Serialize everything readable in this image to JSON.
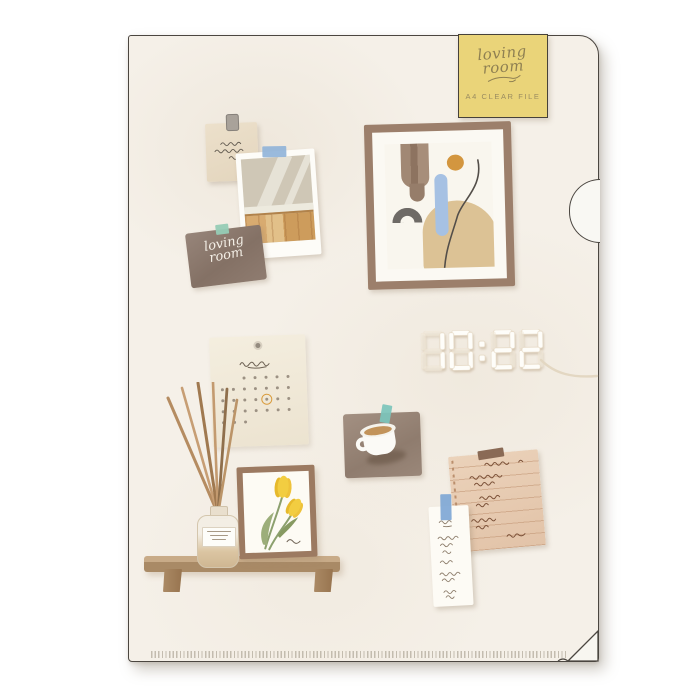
{
  "product_label": {
    "script_line1": "loving",
    "script_line2": "room",
    "subtitle": "A4 CLEAR FILE",
    "bg_color": "#ead479"
  },
  "wall_card": {
    "script_line1": "loving",
    "script_line2": "room"
  },
  "clock": {
    "time": "10:22"
  },
  "calendar": {
    "rows": [
      {
        "start": 2,
        "end": 6
      },
      {
        "start": 0,
        "end": 6
      },
      {
        "start": 0,
        "end": 6
      },
      {
        "start": 0,
        "end": 6
      },
      {
        "start": 0,
        "end": 2
      }
    ],
    "circled": {
      "row": 2,
      "col": 4
    },
    "circle_color": "#d99b3c"
  },
  "palette": {
    "file_background": "#f5f0e8",
    "outline": "#4b4640",
    "label_yellow": "#ead479",
    "frame_brown": "#9c7f6b",
    "tape_blue": "#8fb3d8",
    "tape_mint": "#96ccb5",
    "tape_teal": "#7cc4bb",
    "tape_brown": "#8a6a55",
    "tulip_yellow": "#f0c93d",
    "note_tan": "#e7ccb3",
    "card_brown": "#8e7b70"
  }
}
